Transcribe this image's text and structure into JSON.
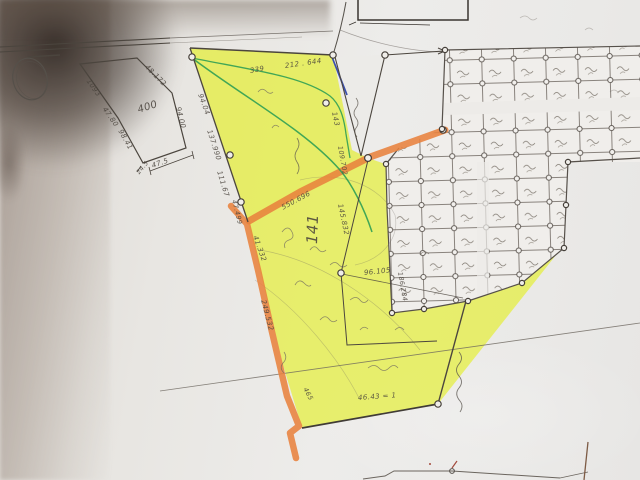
{
  "photo": {
    "description_label": "hand-drawn cadastral sketch map, photographed paper",
    "parcel_number": "141"
  },
  "colors": {
    "paper": "#eae8e5",
    "highlight_yellow": "#e4ee3c",
    "highlight_orange": "#e8823d",
    "pen_green": "#2f9e54",
    "pen_blue": "#3b4fae",
    "pencil_dark": "#4b453e",
    "pencil_light": "#6b655e",
    "mark_red": "#a34a3c",
    "mark_brown": "#7d5b45",
    "shadow_brown": "#8c7d72"
  },
  "map": {
    "annotations": [
      {
        "text": "1093",
        "x": 88,
        "y": 76,
        "rot": 55,
        "size": 7
      },
      {
        "text": "47.80",
        "x": 104,
        "y": 104,
        "rot": 55,
        "size": 7
      },
      {
        "text": "48.172",
        "x": 146,
        "y": 62,
        "rot": 45,
        "size": 7
      },
      {
        "text": "400",
        "x": 138,
        "y": 105,
        "rot": -18,
        "size": 10
      },
      {
        "text": "94.00",
        "x": 178,
        "y": 103,
        "rot": 76,
        "size": 7
      },
      {
        "text": "98.41",
        "x": 120,
        "y": 126,
        "rot": 61,
        "size": 7
      },
      {
        "text": "47.5",
        "x": 152,
        "y": 162,
        "rot": -19,
        "size": 7
      },
      {
        "text": "24.5",
        "x": 138,
        "y": 170,
        "rot": -50,
        "size": 6
      },
      {
        "text": "339",
        "x": 250,
        "y": 67,
        "rot": -10,
        "size": 7
      },
      {
        "text": "212 . 644",
        "x": 285,
        "y": 62,
        "rot": -8,
        "size": 7
      },
      {
        "text": "94.04",
        "x": 200,
        "y": 90,
        "rot": 70,
        "size": 7
      },
      {
        "text": "137.990",
        "x": 209,
        "y": 126,
        "rot": 72,
        "size": 7
      },
      {
        "text": "111.67",
        "x": 219,
        "y": 167,
        "rot": 73,
        "size": 7
      },
      {
        "text": "47.499",
        "x": 234,
        "y": 196,
        "rot": 76,
        "size": 6.5
      },
      {
        "text": "143",
        "x": 334,
        "y": 108,
        "rot": 78,
        "size": 7
      },
      {
        "text": "109.702",
        "x": 340,
        "y": 142,
        "rot": 80,
        "size": 6.5
      },
      {
        "text": "550.696",
        "x": 282,
        "y": 204,
        "rot": -28,
        "size": 7
      },
      {
        "text": "41.332",
        "x": 255,
        "y": 232,
        "rot": 70,
        "size": 7
      },
      {
        "text": "249.532",
        "x": 263,
        "y": 296,
        "rot": 75,
        "size": 7
      },
      {
        "text": "141",
        "x": 312,
        "y": 235,
        "rot": -88,
        "size": 15
      },
      {
        "text": "145.832",
        "x": 340,
        "y": 200,
        "rot": 78,
        "size": 7
      },
      {
        "text": "96.105",
        "x": 364,
        "y": 269,
        "rot": -6,
        "size": 7
      },
      {
        "text": "186.284",
        "x": 400,
        "y": 268,
        "rot": 80,
        "size": 6.5
      },
      {
        "text": "46.43 = 1",
        "x": 358,
        "y": 394,
        "rot": -4,
        "size": 7
      },
      {
        "text": "465",
        "x": 305,
        "y": 384,
        "rot": 62,
        "size": 6.5
      }
    ]
  }
}
